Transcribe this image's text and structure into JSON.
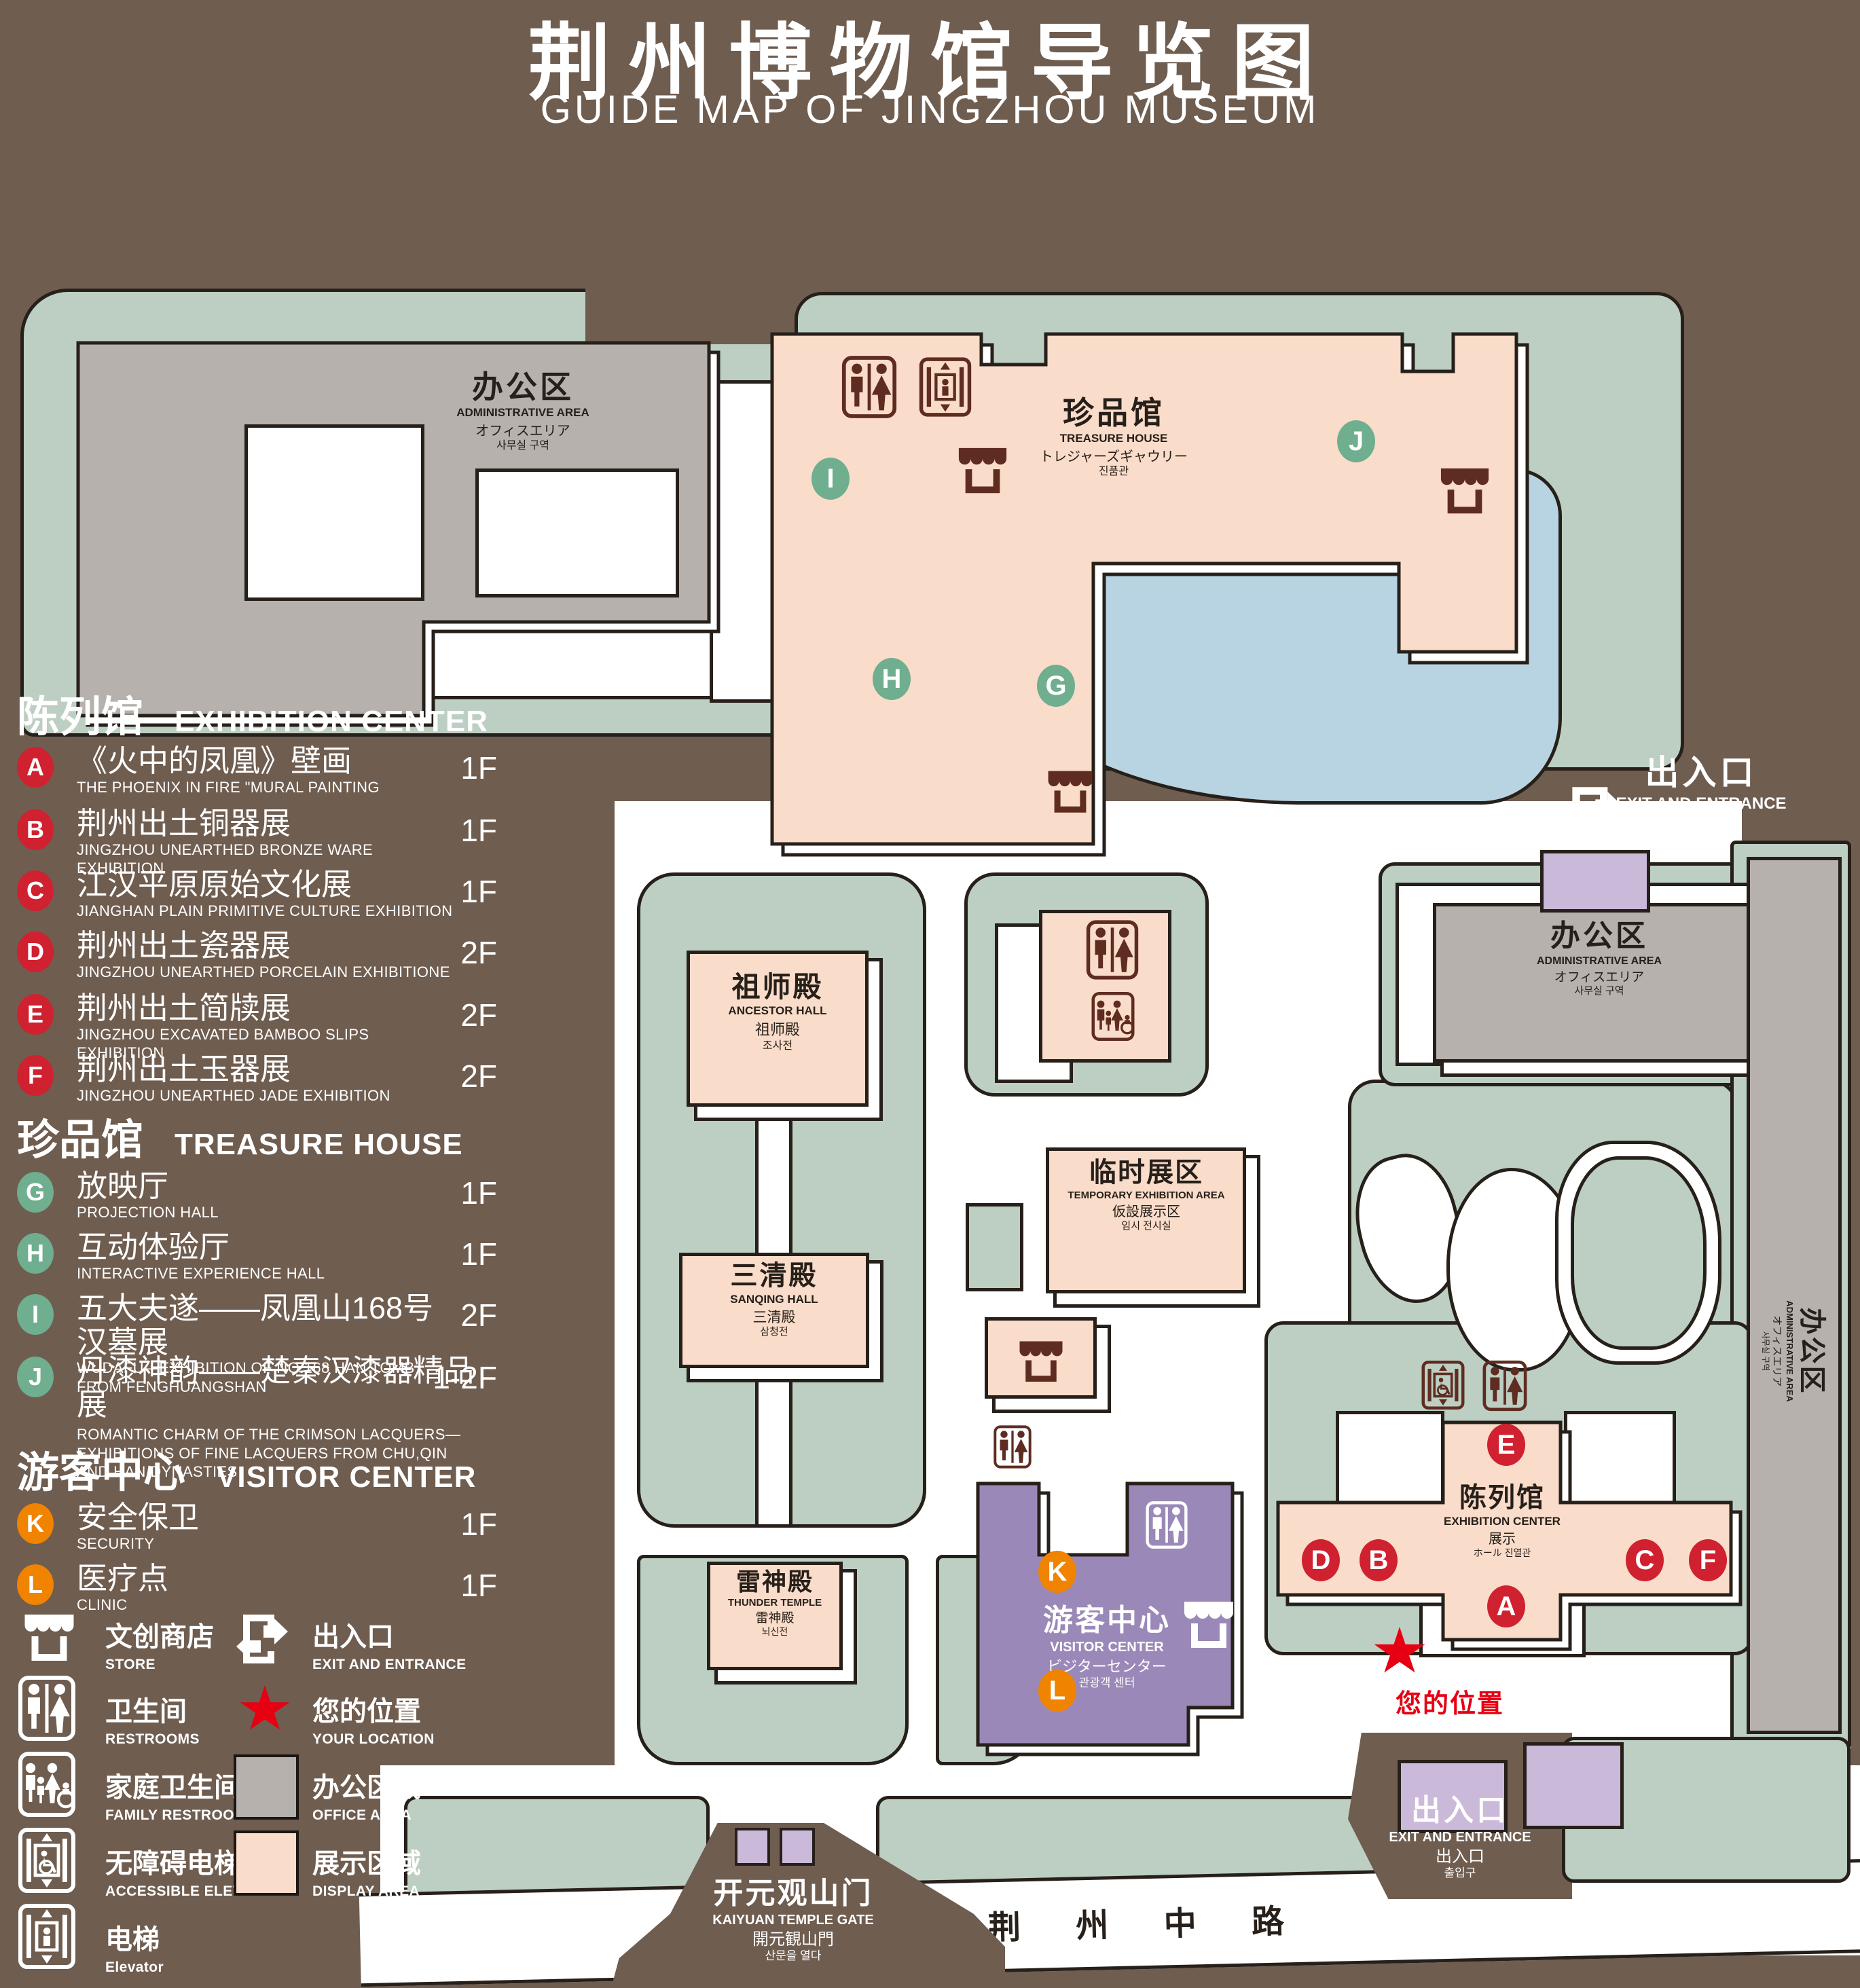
{
  "title": {
    "zh": "荆州博物馆导览图",
    "en": "GUIDE MAP OF JINGZHOU MUSEUM"
  },
  "legend": {
    "sections": [
      {
        "zh": "陈列馆",
        "en": "EXHIBITION CENTER",
        "items": [
          {
            "k": "A",
            "zh": "《火中的凤凰》壁画",
            "en": "THE PHOENIX IN FIRE \"MURAL PAINTING",
            "floor": "1F"
          },
          {
            "k": "B",
            "zh": "荆州出土铜器展",
            "en": "JINGZHOU UNEARTHED BRONZE WARE EXHIBITION",
            "floor": "1F"
          },
          {
            "k": "C",
            "zh": "江汉平原原始文化展",
            "en": "JIANGHAN PLAIN PRIMITIVE CULTURE EXHIBITION",
            "floor": "1F"
          },
          {
            "k": "D",
            "zh": "荆州出土瓷器展",
            "en": "JINGZHOU UNEARTHED PORCELAIN EXHIBITIONE",
            "floor": "2F"
          },
          {
            "k": "E",
            "zh": "荆州出土简牍展",
            "en": "JINGZHOU EXCAVATED BAMBOO SLIPS EXHIBITION",
            "floor": "2F"
          },
          {
            "k": "F",
            "zh": "荆州出土玉器展",
            "en": "JINGZHOU UNEARTHED JADE EXHIBITION",
            "floor": "2F"
          }
        ]
      },
      {
        "zh": "珍品馆",
        "en": "TREASURE HOUSE",
        "items": [
          {
            "k": "G",
            "zh": "放映厅",
            "en": "PROJECTION HALL",
            "floor": "1F"
          },
          {
            "k": "H",
            "zh": "互动体验厅",
            "en": "INTERACTIVE EXPERIENCE HALL",
            "floor": "1F"
          },
          {
            "k": "I",
            "zh": "五大夫遂——凤凰山168号汉墓展",
            "en": "WUDAFU—EXHIBITION OF NO.168 HAN TOMB FROM FENGHUANGSHAN",
            "floor": "2F"
          },
          {
            "k": "J",
            "zh": "丹漆神韵——楚秦汉漆器精品展",
            "en": "ROMANTIC CHARM OF THE CRIMSON LACQUERS—EXHIBITIONS OF FINE LACQUERS FROM CHU,QIN AND HAN DYNASTIES",
            "floor": "1-2F"
          }
        ]
      },
      {
        "zh": "游客中心",
        "en": "VISITOR CENTER",
        "items": [
          {
            "k": "K",
            "zh": "安全保卫",
            "en": "SECURITY",
            "floor": "1F"
          },
          {
            "k": "L",
            "zh": "医疗点",
            "en": "CLINIC",
            "floor": "1F"
          }
        ]
      }
    ],
    "symbols": [
      {
        "zh": "文创商店",
        "en": "STORE"
      },
      {
        "zh": "卫生间",
        "en": "RESTROOMS"
      },
      {
        "zh": "家庭卫生间",
        "en": "FAMILY RESTROOMS"
      },
      {
        "zh": "无障碍电梯",
        "en": "ACCESSIBLE ELEVATOR"
      },
      {
        "zh": "电梯",
        "en": "Elevator"
      },
      {
        "zh": "出入口",
        "en": "EXIT AND ENTRANCE"
      },
      {
        "zh": "您的位置",
        "en": "YOUR LOCATION"
      },
      {
        "zh": "办公区域",
        "en": "OFFICE AREA"
      },
      {
        "zh": "展示区域",
        "en": "DISPLAY AREA"
      }
    ]
  },
  "map": {
    "admin": {
      "zh": "办公区",
      "en": "ADMINISTRATIVE AREA",
      "l3": "オフィスエリア",
      "l4": "사무실 구역"
    },
    "treasure": {
      "zh": "珍品馆",
      "en": "TREASURE HOUSE",
      "l3": "トレジャーズギャウリー",
      "l4": "진품관"
    },
    "ancestor": {
      "zh": "祖师殿",
      "en": "ANCESTOR HALL",
      "l3": "祖师殿",
      "l4": "조사전"
    },
    "sanqing": {
      "zh": "三清殿",
      "en": "SANQING HALL",
      "l3": "三清殿",
      "l4": "삼청전"
    },
    "thunder": {
      "zh": "雷神殿",
      "en": "THUNDER TEMPLE",
      "l3": "雷神殿",
      "l4": "뇌신전"
    },
    "temporary": {
      "zh": "临时展区",
      "en": "TEMPORARY EXHIBITION AREA",
      "l3": "仮設展示区",
      "l4": "임시 전시실"
    },
    "visitor": {
      "zh": "游客中心",
      "en": "VISITOR CENTER",
      "l3": "ビジターセンター",
      "l4": "관광객 센터"
    },
    "exhibition": {
      "zh": "陈列馆",
      "en": "EXHIBITION CENTER",
      "l3": "展示",
      "l4": "ホール 진열관"
    },
    "gate": {
      "zh": "开元观山门",
      "en": "KAIYUAN TEMPLE GATE",
      "l3": "開元観山門",
      "l4": "산문을 열다"
    },
    "exit": {
      "zh": "出入口",
      "en": "EXIT AND ENTRANCE",
      "l3": "出入口",
      "l4": "출입구"
    },
    "road": "荆 州 中 路",
    "your_location": "您的位置",
    "markers": {
      "A": "A",
      "B": "B",
      "C": "C",
      "D": "D",
      "E": "E",
      "F": "F",
      "G": "G",
      "H": "H",
      "I": "I",
      "J": "J",
      "K": "K",
      "L": "L"
    }
  },
  "colors": {
    "background": "#6f5d50",
    "green_area": "#bccfc2",
    "display_area": "#f9dcc9",
    "office_area": "#b6b1ac",
    "lake": "#b8d4e2",
    "visitor_purple": "#9a89b8",
    "gate_purple": "#cbb9da",
    "marker_red": "#cf2130",
    "marker_green": "#6fae8e",
    "marker_orange": "#f08300",
    "icon_maroon": "#5f2c21",
    "location_red": "#e60012"
  }
}
